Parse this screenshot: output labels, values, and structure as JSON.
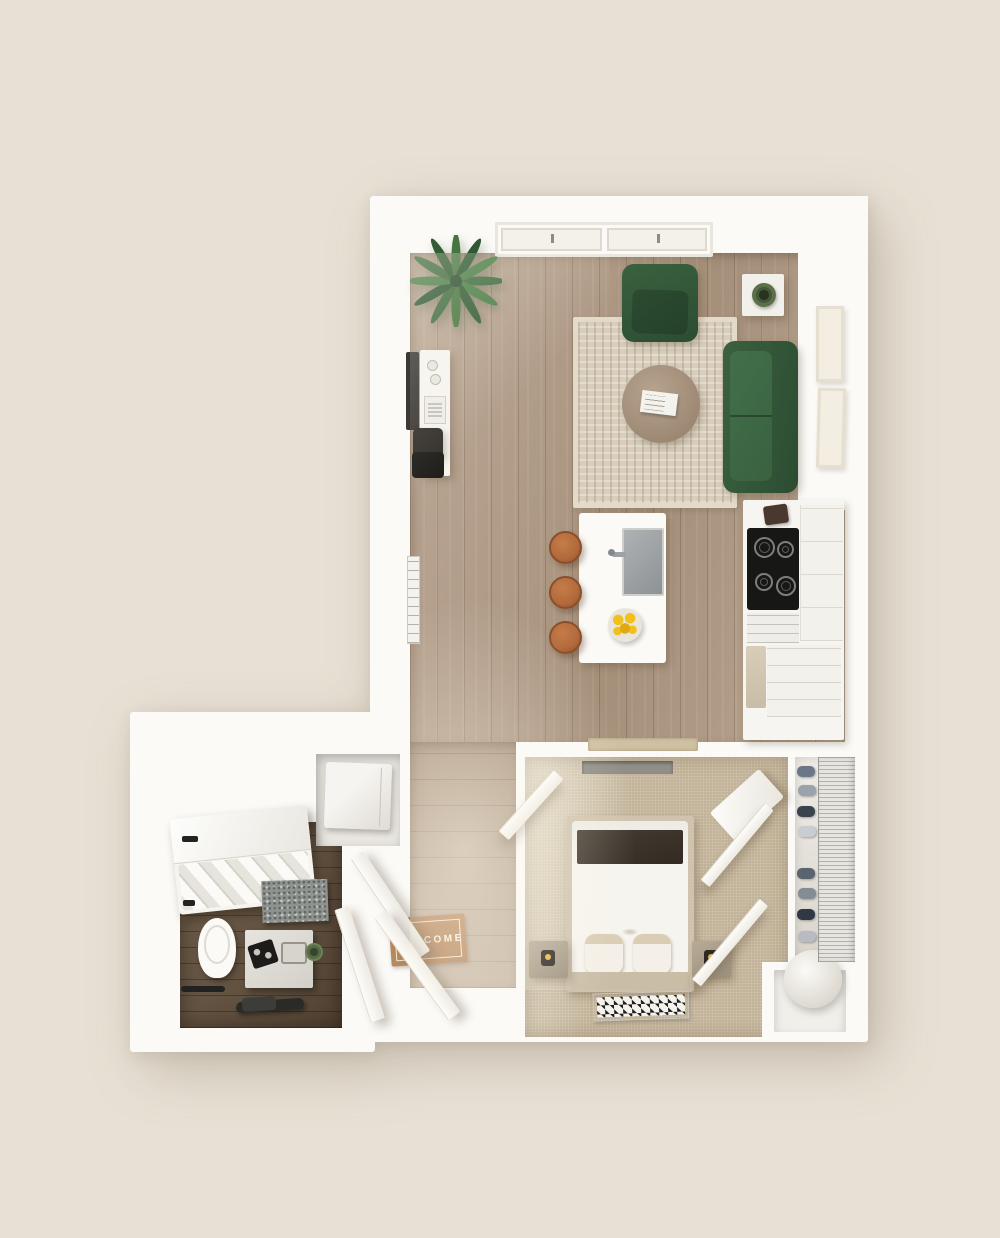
{
  "scene": {
    "kind": "3d-rendered-top-down-floor-plan",
    "subject": "studio-apartment"
  },
  "palette": {
    "bg": "#E7E0D4",
    "wall": "#FBFAF7",
    "wood": "#B19B85",
    "carpet": "#C3B49A",
    "bathWood": "#64523F",
    "green": "#3A6140",
    "greenDark": "#2C4C31",
    "rug": "#D8CEBB",
    "leather": "#B26A3C",
    "leatherDark": "#8C4F28",
    "matBrown": "#B8895E",
    "marble": "#8F938F",
    "lemon": "#F2C01D"
  },
  "entry": {
    "welcome_mat_text": "WELCOME"
  },
  "rooms": {
    "living_kitchen": {
      "floor": "wood-plank",
      "furniture": [
        "window",
        "palm-plant",
        "wall-tv",
        "desk",
        "desk-chair",
        "area-rug",
        "round-coffee-table",
        "magazine",
        "green-armchair",
        "green-sofa",
        "side-table",
        "potted-plant",
        "wall-art-frame",
        "wall-art-frame",
        "kitchen-island",
        "sink",
        "faucet",
        "lemon-bowl",
        "bar-stool",
        "bar-stool",
        "bar-stool",
        "cooktop-stove",
        "oven-drawer",
        "coffee-maker",
        "fridge-panel",
        "cabinets",
        "kitchen-mat",
        "wall-mirror"
      ]
    },
    "bedroom": {
      "floor": "carpet",
      "furniture": [
        "bed",
        "headboard",
        "dark-throw-blanket",
        "pillow",
        "pillow",
        "nightstand",
        "nightstand",
        "table-lamp",
        "table-lamp",
        "foot-rug",
        "transom-window",
        "closet-door",
        "closet-door",
        "dresser-panel",
        "bedroom-door"
      ]
    },
    "closet": {
      "floor": "laminate",
      "furniture": [
        "wire-shelving",
        "shoes"
      ]
    },
    "utility": {
      "furniture": [
        "washer-dryer",
        "water-heater-tank"
      ]
    },
    "bathroom": {
      "floor": "dark-wood",
      "furniture": [
        "bathtub-shower",
        "glass-panel",
        "towels",
        "black-faucet",
        "marble-backsplash",
        "toilet",
        "vanity",
        "toiletry-tray",
        "sink-basin",
        "small-plant",
        "towel-bar",
        "grab-bar",
        "toilet-paper-holder",
        "bathroom-door"
      ]
    },
    "entry": {
      "furniture": [
        "welcome-mat",
        "entry-door-leaf",
        "entry-door-leaf"
      ]
    }
  }
}
